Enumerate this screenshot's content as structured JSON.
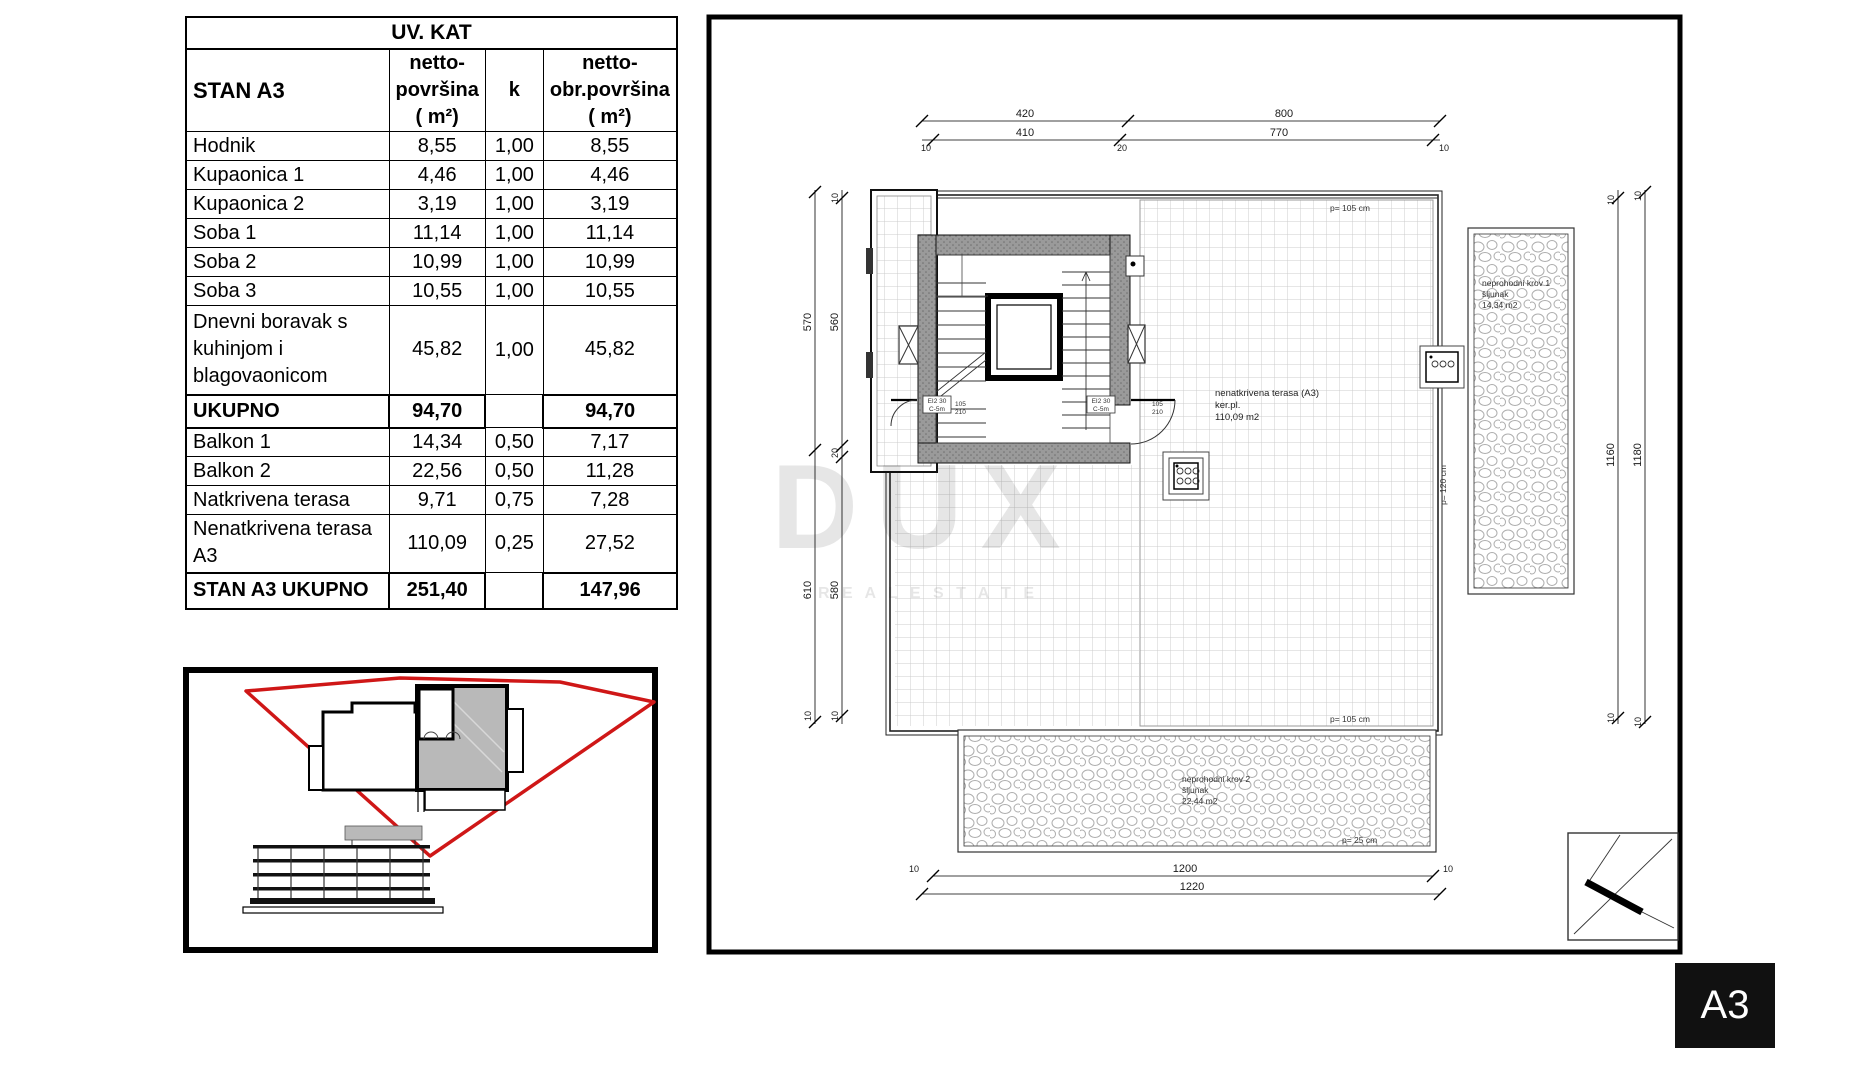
{
  "table": {
    "title": "UV. KAT",
    "header": {
      "name": "STAN A3",
      "netto": "netto-\npovršina\n( m²)",
      "k": "k",
      "obr": "netto-\nobr.površina\n( m²)"
    },
    "rows": [
      {
        "name": "Hodnik",
        "netto": "8,55",
        "k": "1,00",
        "obr": "8,55"
      },
      {
        "name": "Kupaonica 1",
        "netto": "4,46",
        "k": "1,00",
        "obr": "4,46"
      },
      {
        "name": "Kupaonica 2",
        "netto": "3,19",
        "k": "1,00",
        "obr": "3,19"
      },
      {
        "name": "Soba 1",
        "netto": "11,14",
        "k": "1,00",
        "obr": "11,14"
      },
      {
        "name": "Soba 2",
        "netto": "10,99",
        "k": "1,00",
        "obr": "10,99"
      },
      {
        "name": "Soba 3",
        "netto": "10,55",
        "k": "1,00",
        "obr": "10,55"
      },
      {
        "name": "Dnevni boravak s\nkuhinjom i\nblagovaonicom",
        "netto": "45,82",
        "k": "1,00",
        "obr": "45,82"
      }
    ],
    "subtotal": {
      "name": "UKUPNO",
      "netto": "94,70",
      "k": "",
      "obr": "94,70"
    },
    "rows2": [
      {
        "name": "Balkon 1",
        "netto": "14,34",
        "k": "0,50",
        "obr": "7,17"
      },
      {
        "name": "Balkon 2",
        "netto": "22,56",
        "k": "0,50",
        "obr": "11,28"
      },
      {
        "name": "Natkrivena terasa",
        "netto": "9,71",
        "k": "0,75",
        "obr": "7,28"
      },
      {
        "name": "Nenatkrivena  terasa\nA3",
        "netto": "110,09",
        "k": "0,25",
        "obr": "27,52"
      }
    ],
    "total": {
      "name": "STAN A3 UKUPNO",
      "netto": "251,40",
      "k": "",
      "obr": "147,96"
    }
  },
  "plan": {
    "labels": {
      "terrace1": "nenatkrivena terasa (A3)",
      "terrace2": "ker.pl.",
      "terrace3": "110,09   m2",
      "roof1a": "neprohodni krov 1",
      "roof1b": "šljunak",
      "roof1c": "14,34   m2",
      "roof2a": "neprohodni krov 2",
      "roof2b": "šljunak",
      "roof2c": "22,44   m2",
      "parapet_top": "p= 105 cm",
      "parapet_bottom": "p= 105 cm",
      "parapet_right": "p= 120 cm",
      "parapet_roof": "p= 25 cm",
      "door_tag_line1": "EI2 30",
      "door_tag_line2": "C-5m",
      "door_dim_w": "105",
      "door_dim_h": "210"
    },
    "dims": {
      "top": [
        "420",
        "410",
        "800",
        "770"
      ],
      "top_ticks": [
        "10",
        "20",
        "10"
      ],
      "left": [
        "570",
        "560",
        "20",
        "610",
        "580"
      ],
      "left_ticks": [
        "10",
        "10",
        "10",
        "10"
      ],
      "right": [
        "1160",
        "1180"
      ],
      "right_ticks": [
        "10",
        "10",
        "10",
        "10"
      ],
      "bottom": [
        "1200",
        "1220"
      ],
      "bottom_ticks": [
        "10",
        "10"
      ]
    }
  },
  "watermark": {
    "line1": "DUX",
    "line2": "R E A L   E S T A T E"
  },
  "badge": {
    "label": "A3"
  },
  "colors": {
    "red_boundary": "#cf1717",
    "gray_fill": "#b9b9b9",
    "wall_gray": "#9a9a9a",
    "tile_line": "#cccccc",
    "pebble_line": "#adadad",
    "black": "#000000"
  }
}
